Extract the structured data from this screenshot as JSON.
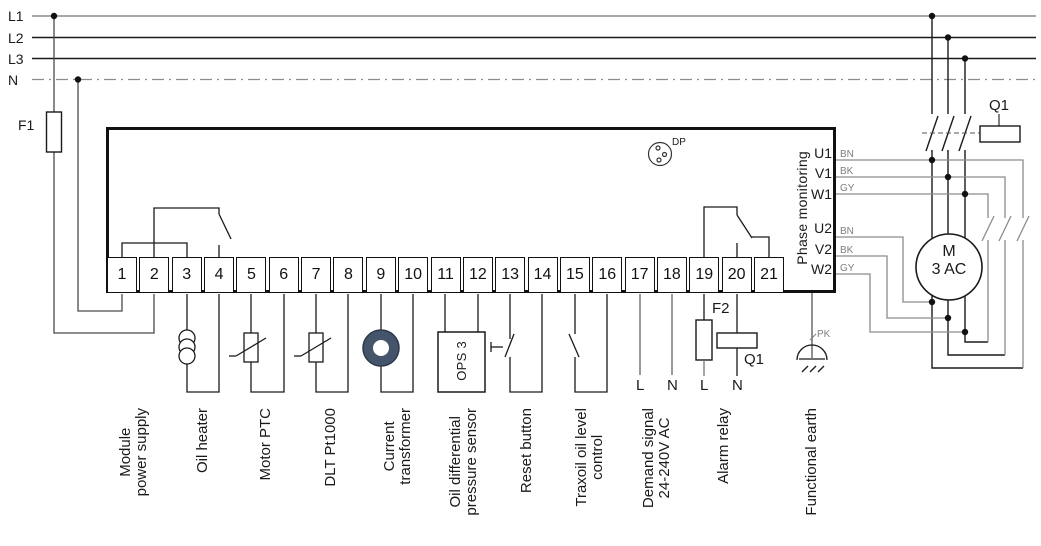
{
  "power_rails": {
    "labels": [
      "L1",
      "L2",
      "L3",
      "N"
    ]
  },
  "fuses": {
    "f1": "F1",
    "f2": "F2"
  },
  "contactor": {
    "label": "Q1",
    "coil_label": "Q1"
  },
  "module": {
    "dp_label": "DP",
    "terminals": [
      "1",
      "2",
      "3",
      "4",
      "5",
      "6",
      "7",
      "8",
      "9",
      "10",
      "11",
      "12",
      "13",
      "14",
      "15",
      "16",
      "17",
      "18",
      "19",
      "20",
      "21"
    ],
    "phase_monitoring": {
      "title": "Phase monitoring",
      "terminals": [
        "U1",
        "V1",
        "W1",
        "U2",
        "V2",
        "W2"
      ],
      "wire_labels": [
        "BN",
        "BK",
        "GY",
        "BN",
        "BK",
        "GY"
      ]
    }
  },
  "motor": {
    "letter": "M",
    "type": "3 AC"
  },
  "earth_wire_label": "PK",
  "sensor_box_label": "OPS 3",
  "wire_end_labels": {
    "t17": "L",
    "t18": "N",
    "t19": "L",
    "t20": "N"
  },
  "bottom_labels": [
    {
      "line1": "Module",
      "line2": "power supply"
    },
    {
      "line1": "Oil heater"
    },
    {
      "line1": "Motor PTC"
    },
    {
      "line1": "DLT Pt1000"
    },
    {
      "line1": "Current",
      "line2": "transformer"
    },
    {
      "line1": "Oil differential",
      "line2": "pressure sensor"
    },
    {
      "line1": "Reset button"
    },
    {
      "line1": "Traxoil oil level",
      "line2": "control"
    },
    {
      "line1": "Demand signal",
      "line2": "24-240V AC"
    },
    {
      "line1": "Alarm relay"
    },
    {
      "line1": "Functional earth"
    }
  ],
  "colors": {
    "wire_gray": "#8c8c8c",
    "line_black": "#1a1a1a",
    "ct_fill": "#44546a"
  }
}
